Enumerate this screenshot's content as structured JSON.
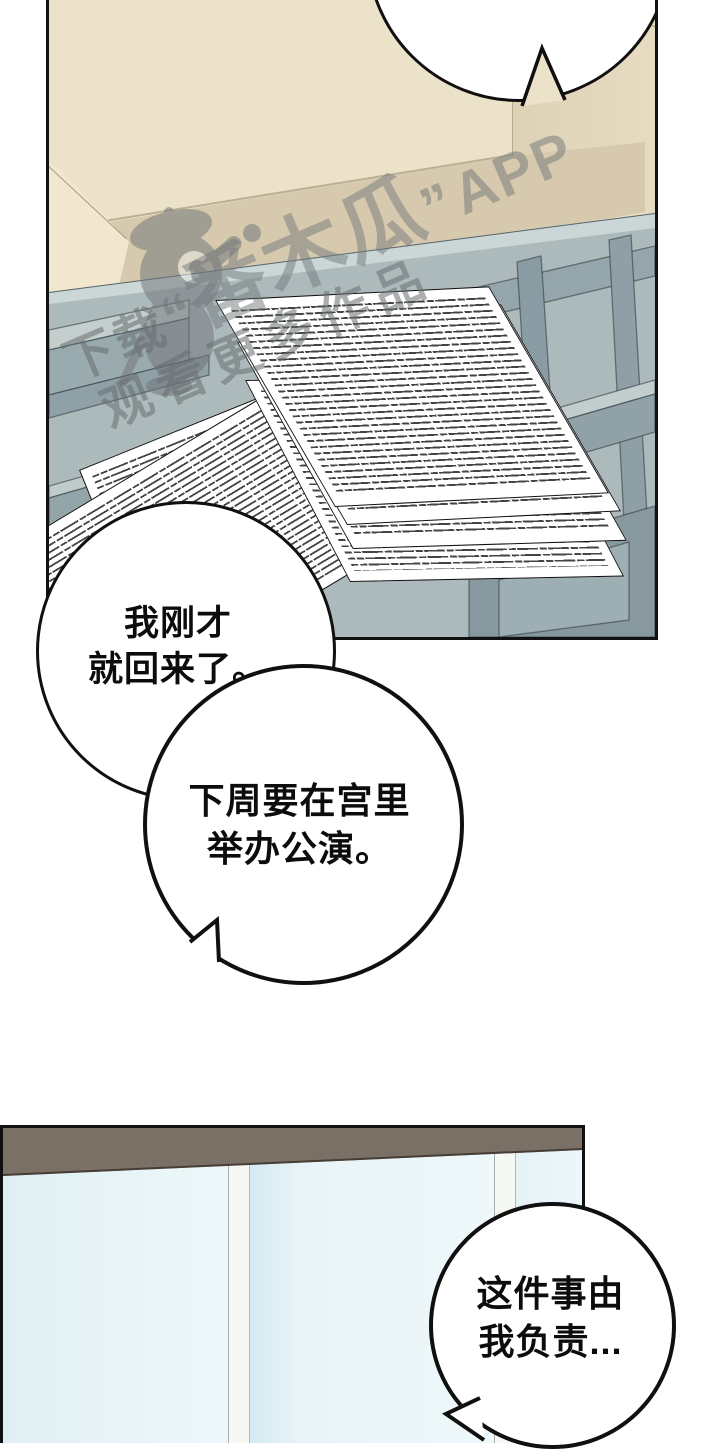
{
  "comic": {
    "bubble_top": {
      "text": ""
    },
    "bubble_1": {
      "line1": "我刚才",
      "line2": "就回来了。"
    },
    "bubble_2": {
      "line1": "下周要在宫里",
      "line2": "举办公演。"
    },
    "bubble_3": {
      "line1": "这件事由",
      "line2": "我负责..."
    }
  },
  "watermark": {
    "download_prefix": "下载",
    "open_quote": "“",
    "app_name": "番木瓜",
    "close_quote": "”",
    "app_word": "APP",
    "slogan": "观看更多作品"
  },
  "colors": {
    "panel_border": "#111111",
    "wall": "#ece1c9",
    "wall_right": "#ddd1b6",
    "seat_top": "#d6c9ad",
    "seat_front": "#e9ddc1",
    "armrest": "#f1e6ce",
    "glass_table": "#adbabc",
    "table_edge_highlight": "#cbd6d6",
    "paper": "#ffffff",
    "valance_brown": "#7b7065",
    "window_blue": "#eaf6f9",
    "mullion_white": "#f6f8f3",
    "bubble_fill": "#ffffff",
    "bubble_stroke": "#101010",
    "watermark_gray": "#6c7174"
  }
}
